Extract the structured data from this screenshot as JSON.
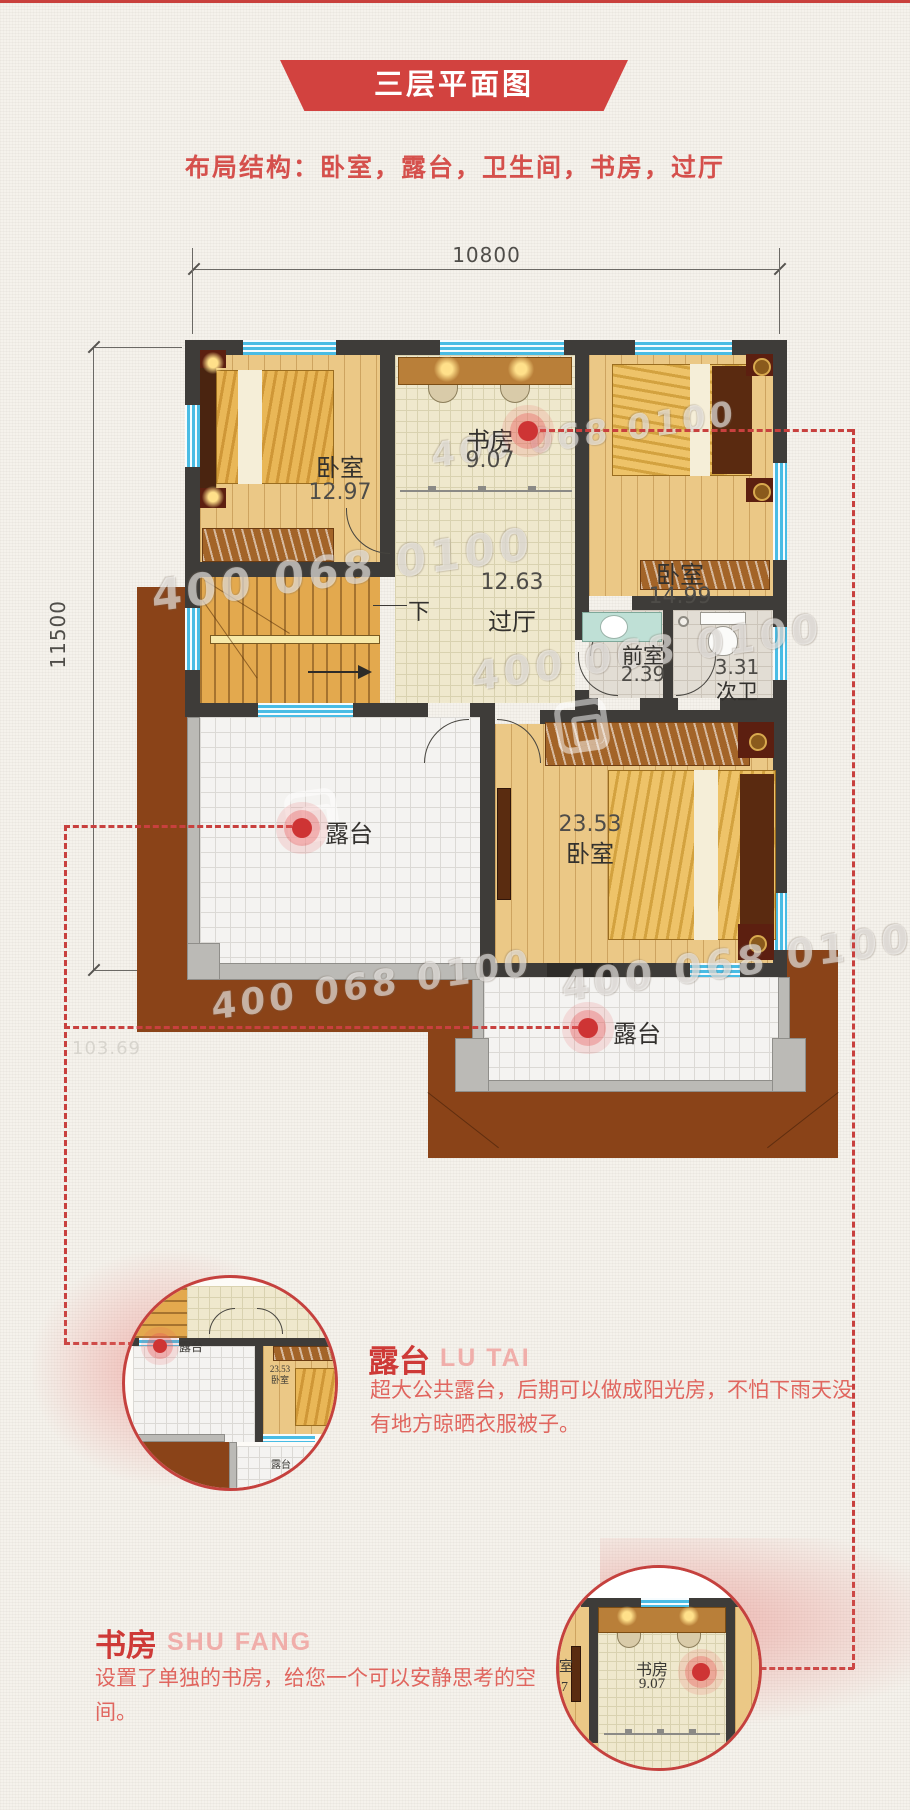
{
  "header": {
    "title": "三层平面图",
    "subtitle": "布局结构：卧室，露台，卫生间，书房，过厅",
    "accent_color": "#d2423f"
  },
  "dimensions": {
    "width_label": "10800",
    "height_label": "11500",
    "area_label": "103.69"
  },
  "floorplan": {
    "watermark": "400 068 0100",
    "stair_direction_label": "下",
    "rooms": [
      {
        "name": "卧室",
        "area": "12.97"
      },
      {
        "name": "书房",
        "area": "9.07"
      },
      {
        "name": "卧室",
        "area": "14.99"
      },
      {
        "name": "过厅",
        "area": "12.63"
      },
      {
        "name": "前室",
        "area": "2.39"
      },
      {
        "name": "次卫",
        "area": "3.31"
      },
      {
        "name": "露台",
        "area": ""
      },
      {
        "name": "卧室",
        "area": "23.53"
      },
      {
        "name": "露台",
        "area": ""
      }
    ]
  },
  "callouts": [
    {
      "title": "露台",
      "latin": "LU TAI",
      "body": "超大公共露台，后期可以做成阳光房，不怕下雨天没有地方晾晒衣服被子。",
      "mini": {
        "terrace": "露台",
        "bedroom_area": "23.53",
        "bedroom_name": "卧室",
        "terrace2": "露台"
      }
    },
    {
      "title": "书房",
      "latin": "SHU FANG",
      "body": "设置了单独的书房，给您一个可以安静思考的空间。",
      "mini": {
        "study": "书房",
        "study_area": "9.07",
        "fragment1": "室",
        "fragment2": "7"
      }
    }
  ],
  "colors": {
    "accent_red": "#d2423f",
    "dashed_red": "#c8403e",
    "wall": "#3e3c39",
    "roof_brown": "#8a4318",
    "window_blue": "#49bce4"
  }
}
